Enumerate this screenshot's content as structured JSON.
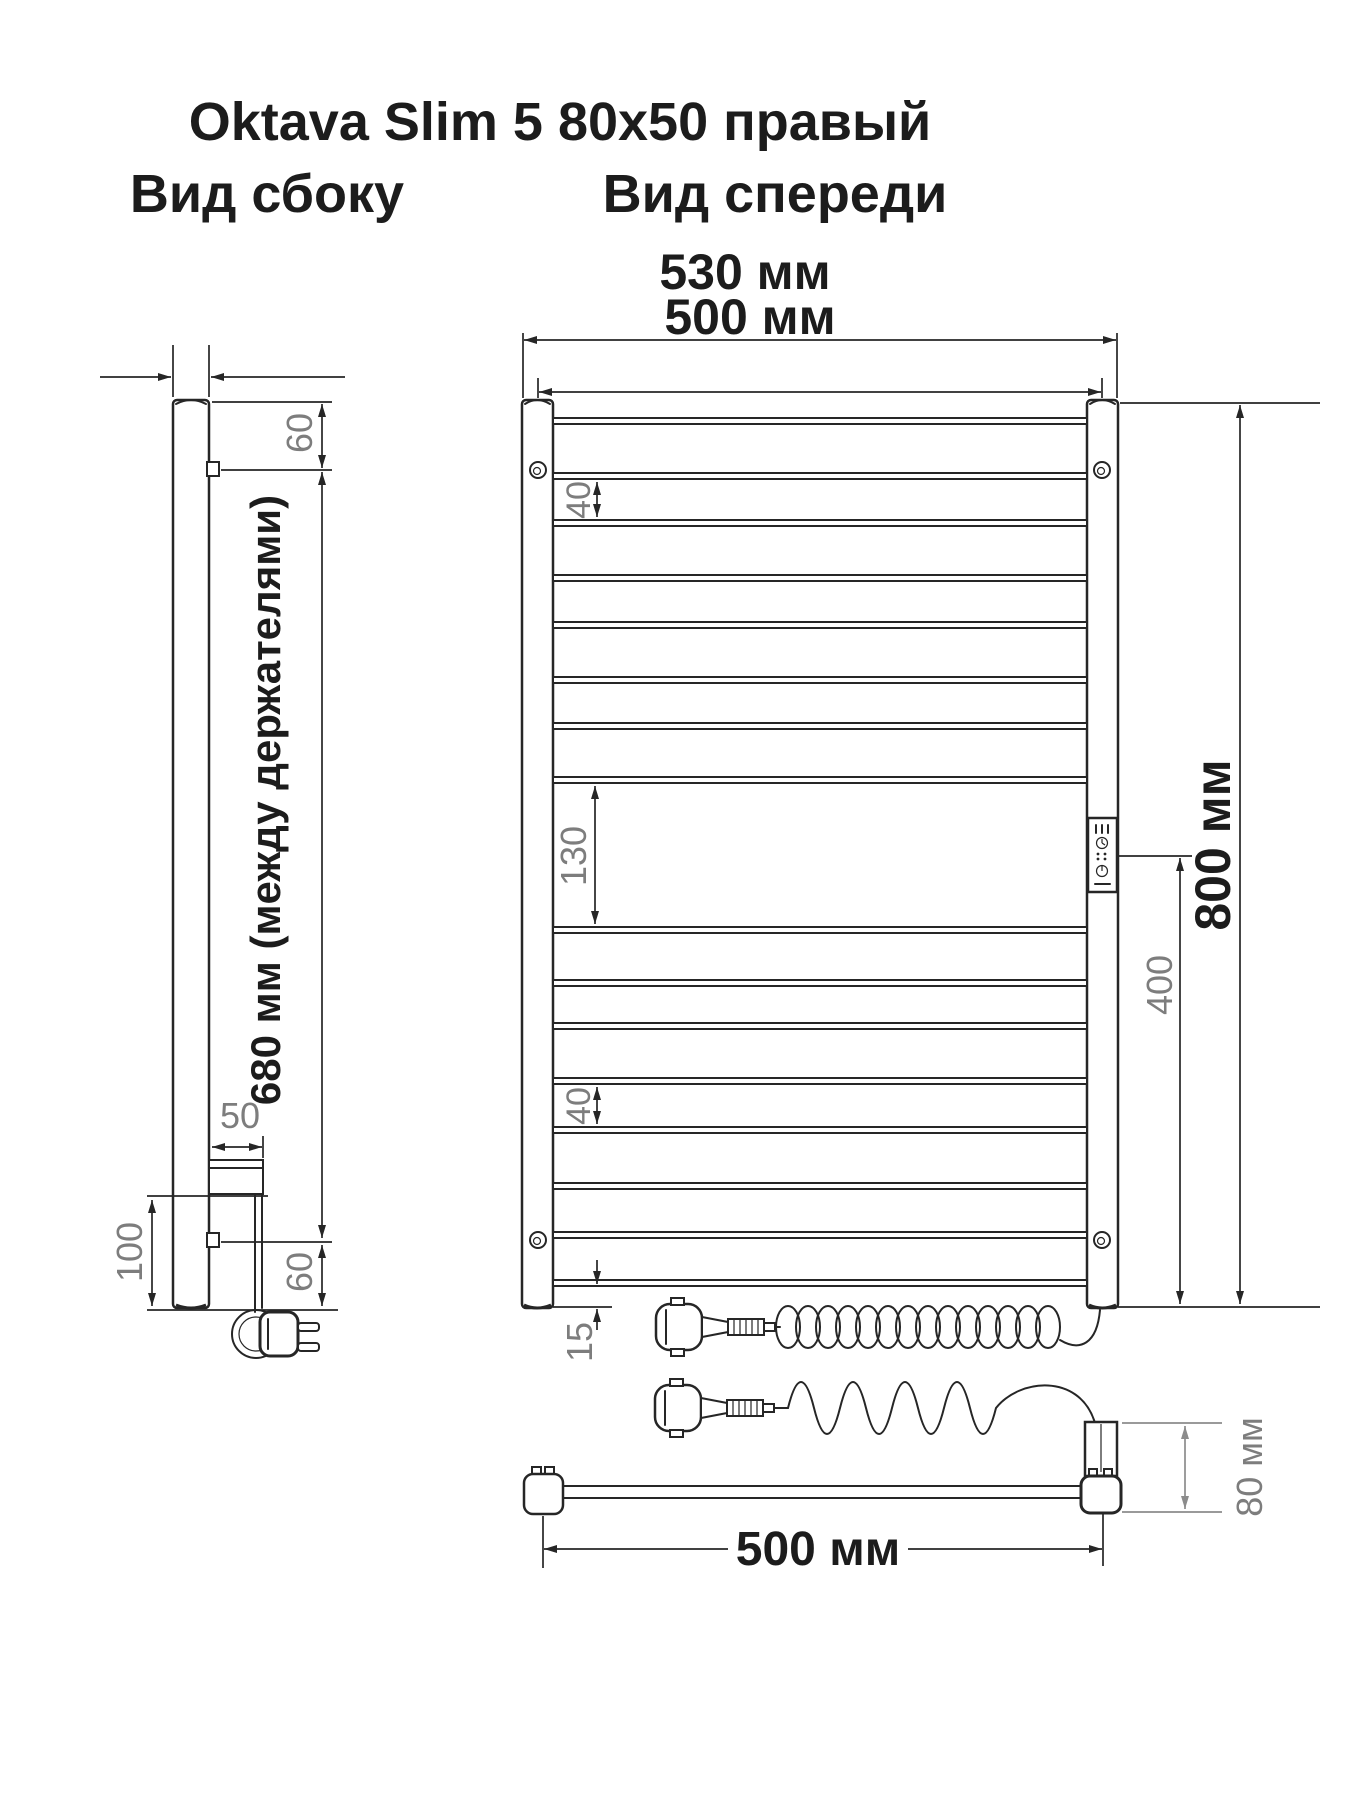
{
  "drawing": {
    "title": "Oktava Slim 5 80x50 правый",
    "side_view": {
      "label": "Вид сбоку",
      "dim_top_offset": "60",
      "dim_between_holders": "680 мм (между держателями)",
      "dim_holder_depth": "50",
      "dim_bottom_height": "100",
      "dim_bottom_offset": "60"
    },
    "front_view": {
      "label": "Вид спереди",
      "dim_overall_width": "530 мм",
      "dim_axis_width": "500 мм",
      "dim_overall_height": "800 мм",
      "dim_panel_to_bottom": "400",
      "dim_group_gap": "130",
      "dim_rung_gap_top": "40",
      "dim_rung_gap_bottom": "40",
      "dim_bottom_clearance": "15"
    },
    "bottom_view": {
      "dim_length": "500 мм",
      "dim_depth": "80 мм"
    },
    "colors": {
      "line": "#262626",
      "dim_gray": "#7d7d7d",
      "background": "#ffffff"
    }
  }
}
